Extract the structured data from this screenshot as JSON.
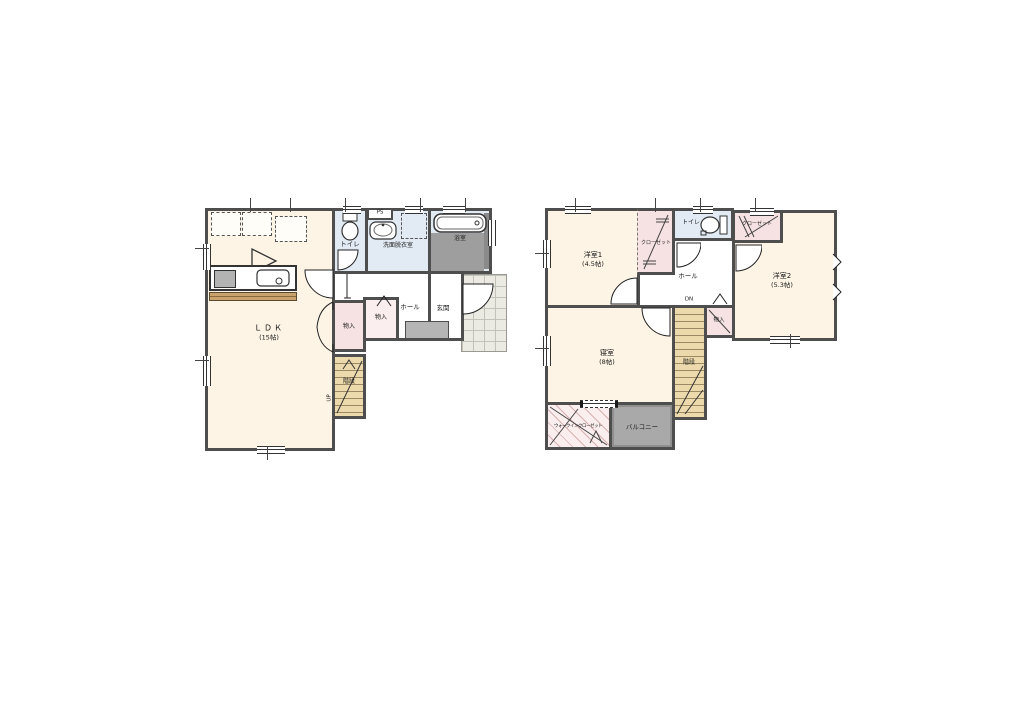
{
  "colors": {
    "wall": "#4e4e4e",
    "room_cream": "#fdf4e5",
    "wet_area_blue": "#e2ebf4",
    "closet_pink": "#f6e2e2",
    "storage_pink_light": "#fbeeee",
    "stairs_tan": "#ecd9ac",
    "balcony_gray": "#a9a9a9",
    "bath_floor_gray": "#9e9e9e",
    "entrance_tile": "#ebebe3",
    "counter_wood": "#c9a36b"
  },
  "floor1": {
    "rooms": {
      "ldk": {
        "label": "ＬＤＫ",
        "size": "(15帖)"
      },
      "toilet": {
        "label": "トイレ"
      },
      "pipe_space": {
        "label": "PS"
      },
      "washroom": {
        "label": "洗面脱衣室"
      },
      "bathroom": {
        "label": "浴室"
      },
      "hall": {
        "label": "ホール"
      },
      "entrance": {
        "label": "玄関"
      },
      "storage_1": {
        "label": "物入"
      },
      "storage_2": {
        "label": "物入"
      },
      "stairs": {
        "label": "階段",
        "direction": "UP"
      }
    }
  },
  "floor2": {
    "rooms": {
      "western_room_1": {
        "label": "洋室1",
        "size": "(4.5帖)"
      },
      "closet_1": {
        "label": "クローゼット"
      },
      "toilet": {
        "label": "トイレ"
      },
      "closet_2": {
        "label": "クローゼット"
      },
      "western_room_2": {
        "label": "洋室2",
        "size": "(5.3帖)"
      },
      "hall": {
        "label": "ホール"
      },
      "bedroom": {
        "label": "寝室",
        "size": "(8帖)"
      },
      "stairs": {
        "label": "階段",
        "direction": "DN"
      },
      "storage": {
        "label": "物入"
      },
      "walk_in_closet": {
        "label": "ウォークインクローゼット"
      },
      "balcony": {
        "label": "バルコニー"
      }
    }
  }
}
